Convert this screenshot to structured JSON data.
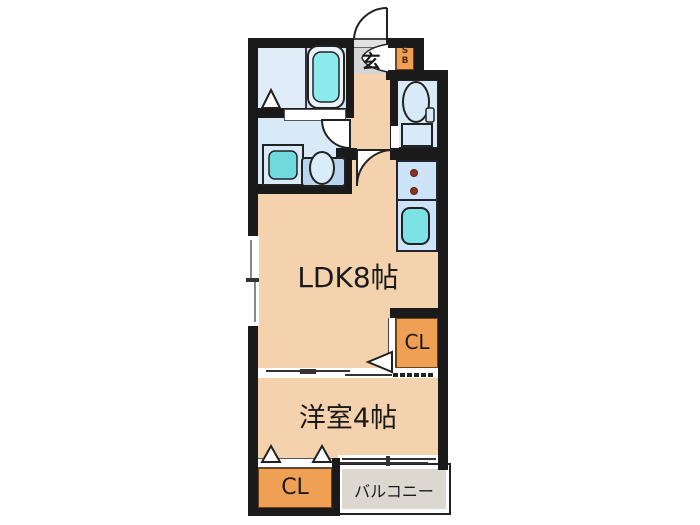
{
  "rooms": {
    "ldk": {
      "label": "LDK8帖"
    },
    "western_room": {
      "label": "洋室4帖"
    },
    "closet_upper": {
      "label": "CL"
    },
    "closet_lower": {
      "label": "CL"
    },
    "balcony": {
      "label": "バルコニー"
    },
    "entrance": {
      "label": "玄"
    },
    "shoe_box": {
      "line1": "S",
      "line2": "B"
    }
  },
  "icons": [
    "bathtub-icon",
    "washing-machine-icon",
    "vanity-sink-icon",
    "toilet-icon",
    "stove-burners-icon",
    "kitchen-sink-icon",
    "entrance-door-arc",
    "washroom-door-arc",
    "ldk-door-arc",
    "closet-fold-triangle",
    "sliding-door-track",
    "window-marks"
  ],
  "colors": {
    "wall": "#1a1a1a",
    "room_fill": "#f4d2ae",
    "wet_area_fill": "#d8e9f8",
    "bath_area_fill": "#cfe2f4",
    "closet_fill": "#f0a055",
    "entrance_fill": "#d6d6d6",
    "balcony_fill": "#dcd7cf",
    "fixture_cyan": "#7de2e4",
    "background": "#ffffff"
  }
}
